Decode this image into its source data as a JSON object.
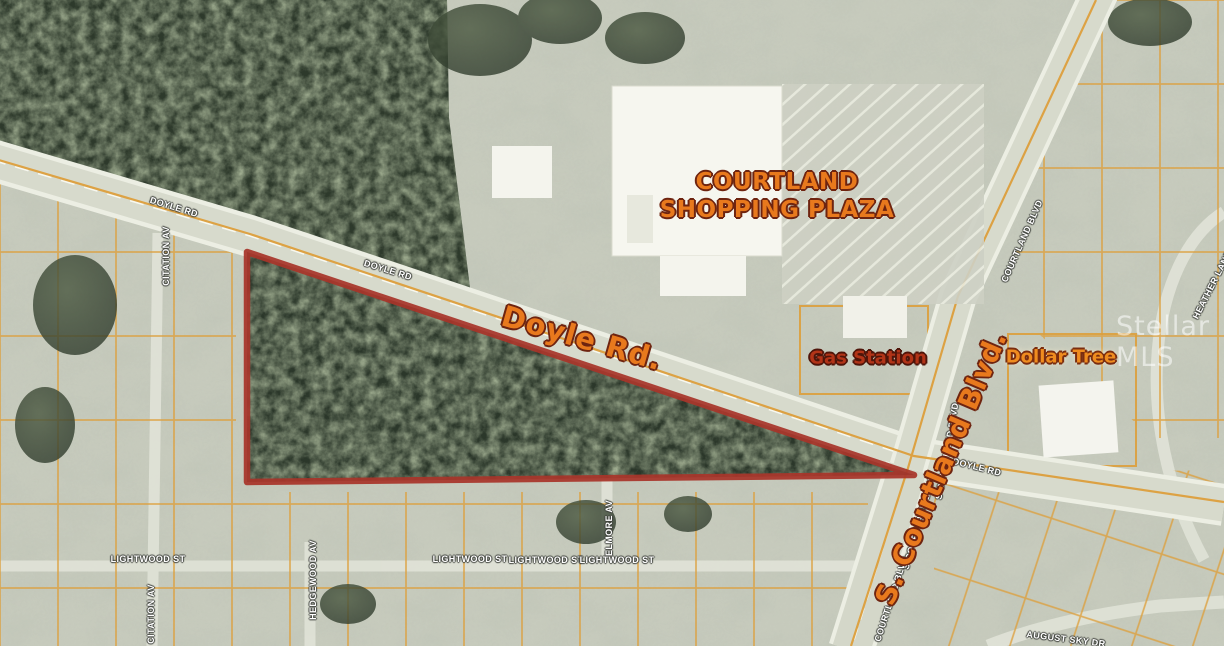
{
  "map": {
    "annotations": {
      "plaza_line1": "COURTLAND",
      "plaza_line2": "SHOPPING PLAZA",
      "doyle_rd": "Doyle Rd.",
      "gas_station": "Gas Station",
      "dollar_tree": "Dollar Tree",
      "s_courtland_blvd": "S. Courtland Blvd."
    },
    "street_labels": [
      {
        "text": "DOYLE RD"
      },
      {
        "text": "DOYLE RD"
      },
      {
        "text": "DOYLE RD"
      },
      {
        "text": "COURTLAND BLVD"
      },
      {
        "text": "S COURTLAND BLVD"
      },
      {
        "text": "S COURTLAND BLVD"
      },
      {
        "text": "COURTLAND BLVD"
      },
      {
        "text": "CITATION AV"
      },
      {
        "text": "CITATION AV"
      },
      {
        "text": "LIGHTWOOD ST"
      },
      {
        "text": "LIGHTWOOD ST"
      },
      {
        "text": "LIGHTWOOD ST"
      },
      {
        "text": "LIGHTWOOD ST"
      },
      {
        "text": "ELMORE AV"
      },
      {
        "text": "HEDGEWOOD AV"
      },
      {
        "text": "HEATHER LANE"
      },
      {
        "text": "AUGUST SKY DR"
      }
    ],
    "watermark": "Stellar MLS",
    "colors": {
      "property_boundary": "#a8352a",
      "parcel_lines": "#dd9f3c",
      "annotation_orange": "#e8791d",
      "street_label_text": "#ffffff"
    }
  }
}
